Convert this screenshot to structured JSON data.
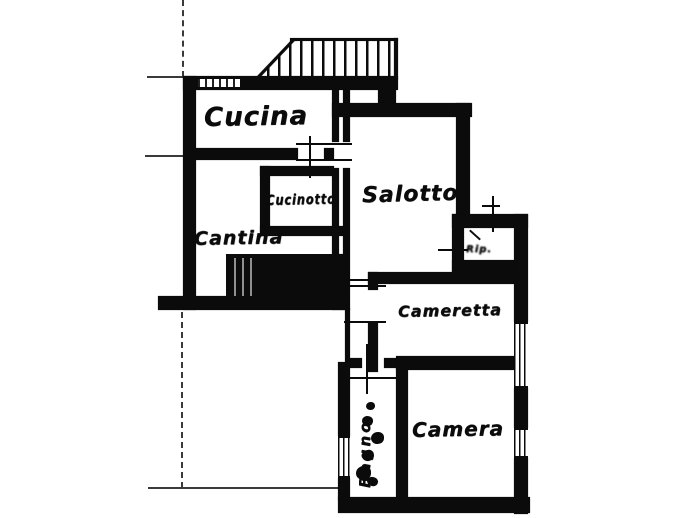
{
  "document": {
    "type": "floor-plan",
    "style": "black-ink scanned cadastral apartment plan, handwritten labels"
  },
  "rooms": [
    {
      "name": "cucina",
      "label": "Cucina"
    },
    {
      "name": "cucinotto",
      "label": "Cucinotto"
    },
    {
      "name": "cantina",
      "label": "Cantina"
    },
    {
      "name": "salotto",
      "label": "Salotto"
    },
    {
      "name": "ripostiglio",
      "label": "Rip."
    },
    {
      "name": "cameretta",
      "label": "Cameretta"
    },
    {
      "name": "camera",
      "label": "Camera"
    },
    {
      "name": "bagno",
      "label": "Bagno"
    }
  ],
  "features": [
    "hatched-balcony-top",
    "solid-black-stair-block",
    "window-symbols-in-walls",
    "door-tick-marks",
    "bathroom-fixtures",
    "thin-property-boundary-lines"
  ],
  "colors": {
    "ink": "#0b0b0b",
    "line": "#3a3a3a",
    "paper": "#ffffff"
  }
}
